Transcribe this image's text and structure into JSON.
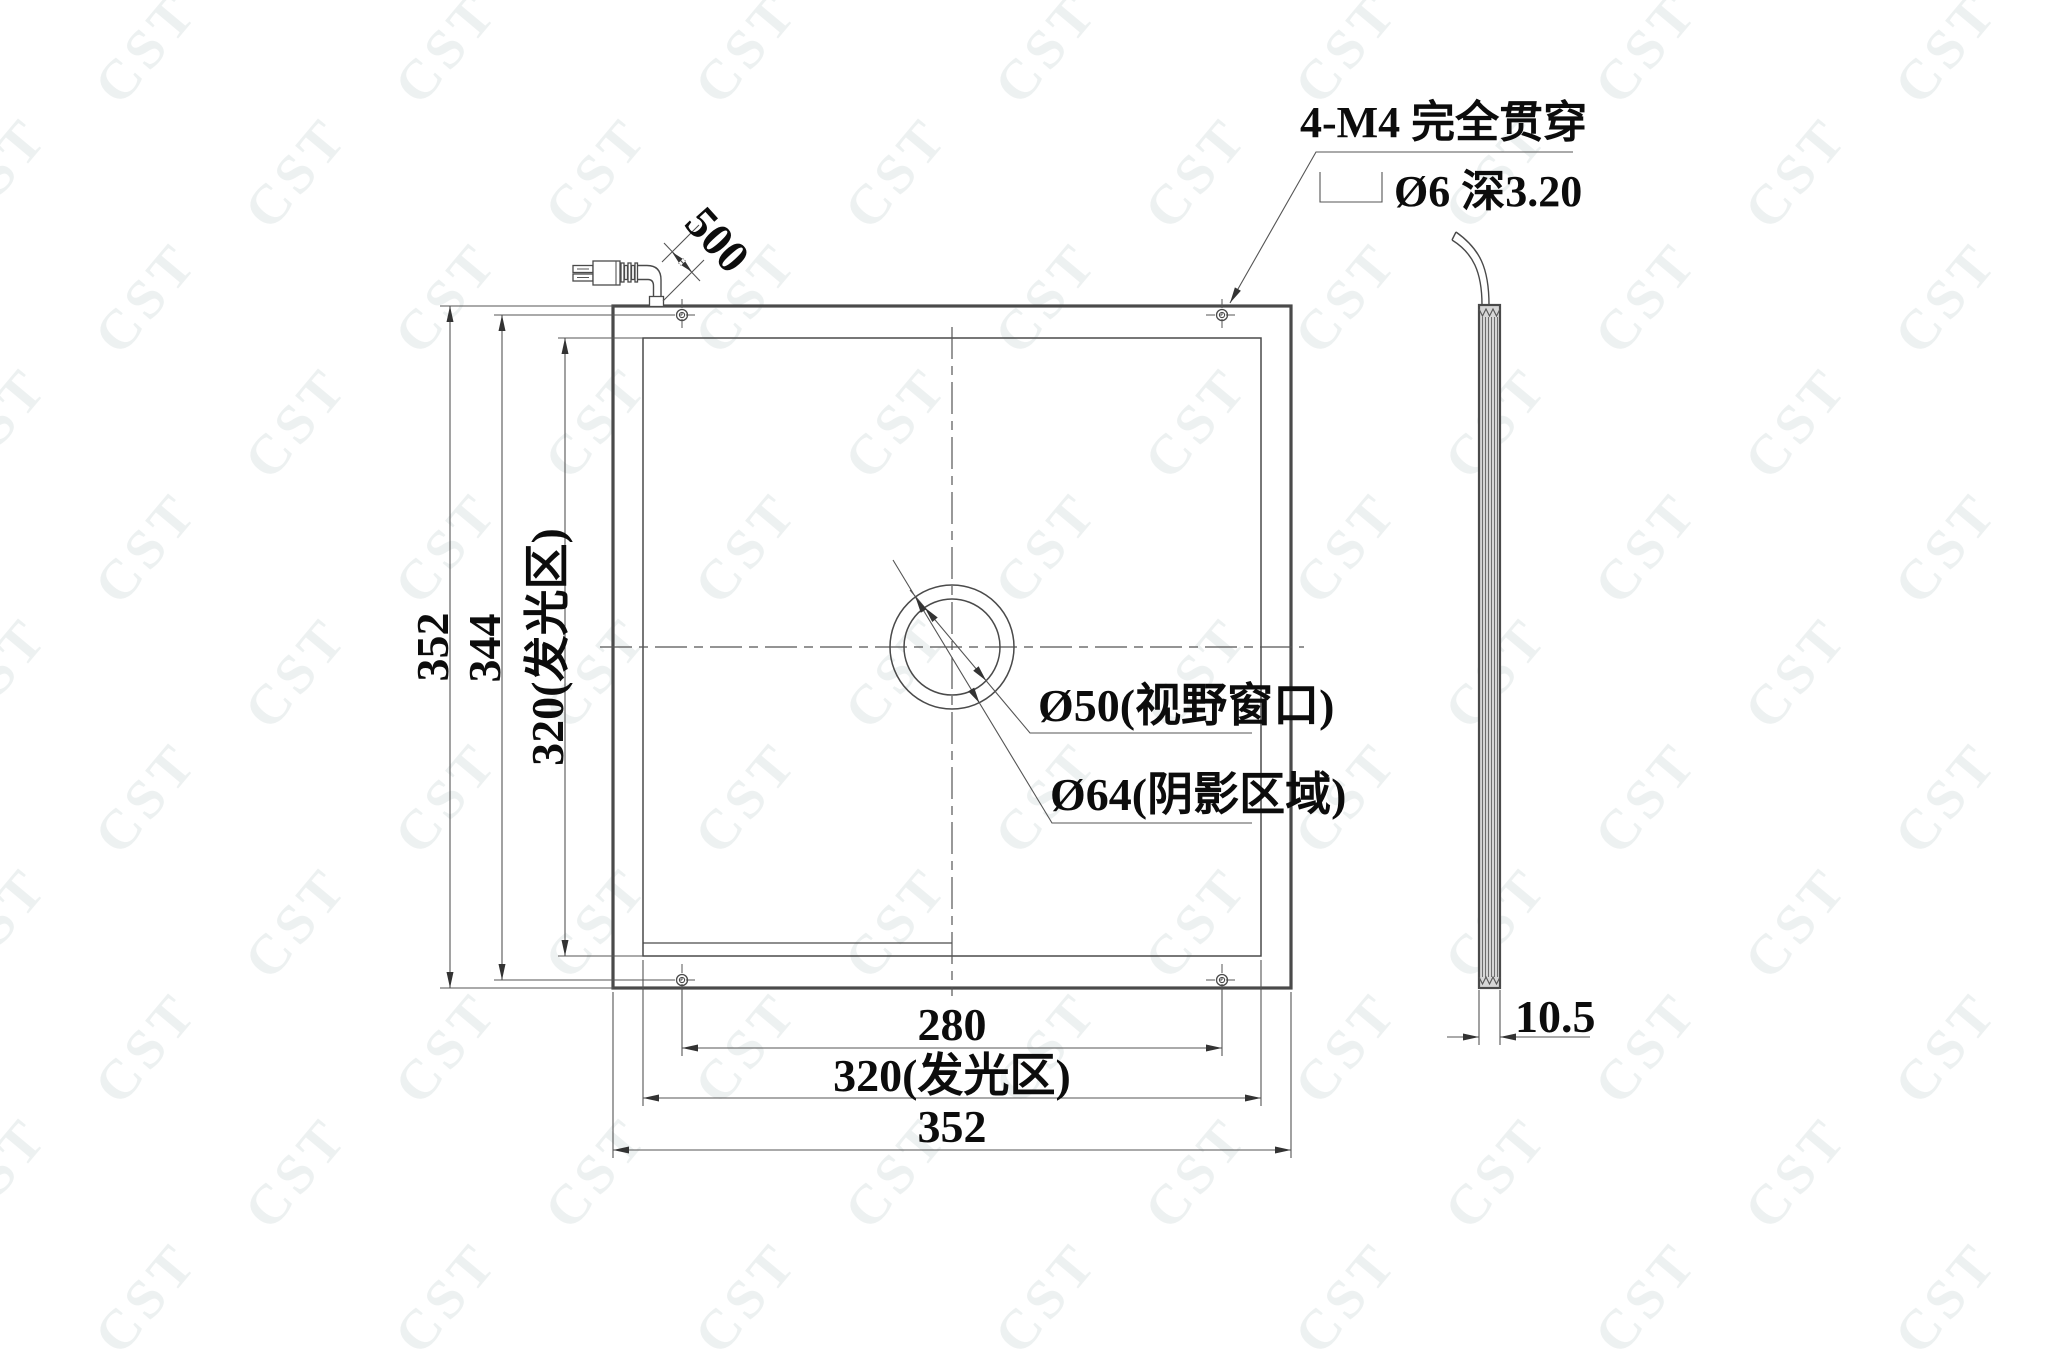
{
  "page": {
    "watermark_text": "CST",
    "background": "#ffffff",
    "line_color": "#4a4a4a",
    "text_color": "#0c0c0c",
    "watermark_color": "#edf1f1"
  },
  "notes": {
    "mounting_holes": "4-M4 完全贯穿",
    "counterbore_symbol": "⌴",
    "counterbore_spec": "Ø6 深3.20"
  },
  "labels": {
    "view_window": "Ø50(视野窗口)",
    "shadow_area": "Ø64(阴影区域)"
  },
  "dims": {
    "cable_length": "500",
    "overall_height": "352",
    "hole_pitch_vertical": "344",
    "luminous_height": "320(发光区)",
    "hole_pitch_horizontal": "280",
    "luminous_width": "320(发光区)",
    "overall_width": "352",
    "thickness": "10.5"
  }
}
